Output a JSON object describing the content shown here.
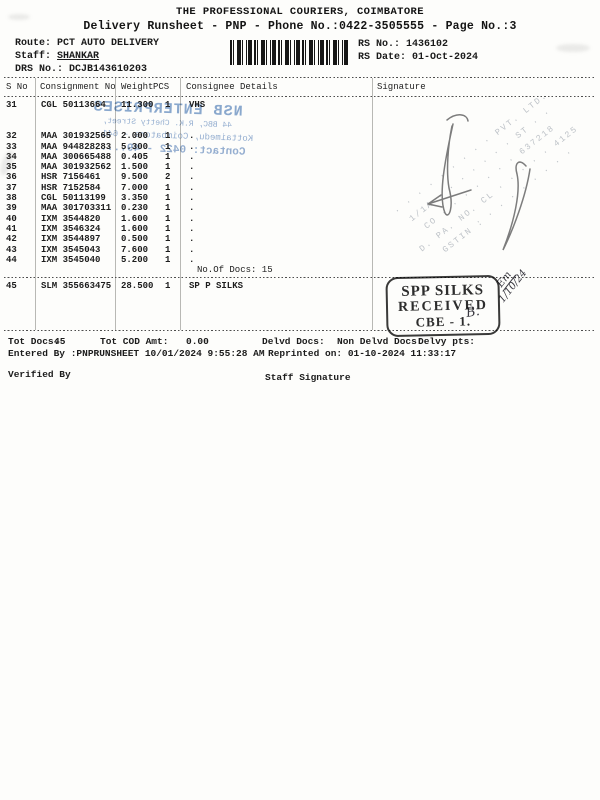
{
  "header": {
    "title": "THE PROFESSIONAL COURIERS, COIMBATORE",
    "subtitle": "Delivery Runsheet - PNP - Phone No.:0422-3505555 - Page No.:3",
    "route_label": "Route:",
    "route_value": "PCT AUTO DELIVERY",
    "staff_label": "Staff:",
    "staff_value": "SHANKAR",
    "drs_label": "DRS No.:",
    "drs_value": "DCJB143610203",
    "rs_no_label": "RS No.:",
    "rs_no_value": "1436102",
    "rs_date_label": "RS Date:",
    "rs_date_value": "01-Oct-2024"
  },
  "table": {
    "columns": [
      "S No",
      "Consignment No",
      "Weight",
      "PCS",
      "Consignee Details",
      "Signature"
    ],
    "rows": [
      {
        "s_no": "31",
        "consignment": "CGL 50113664",
        "weight": "11.300",
        "pcs": "1",
        "consignee": "VHS"
      },
      {
        "s_no": "32",
        "consignment": "MAA 301932565",
        "weight": "2.000",
        "pcs": "1",
        "consignee": "."
      },
      {
        "s_no": "33",
        "consignment": "MAA 944828283",
        "weight": "5.300",
        "pcs": "1",
        "consignee": "."
      },
      {
        "s_no": "34",
        "consignment": "MAA 300665488",
        "weight": "0.405",
        "pcs": "1",
        "consignee": "."
      },
      {
        "s_no": "35",
        "consignment": "MAA 301932562",
        "weight": "1.500",
        "pcs": "1",
        "consignee": "."
      },
      {
        "s_no": "36",
        "consignment": "HSR 7156461",
        "weight": "9.500",
        "pcs": "2",
        "consignee": "."
      },
      {
        "s_no": "37",
        "consignment": "HSR 7152584",
        "weight": "7.000",
        "pcs": "1",
        "consignee": "."
      },
      {
        "s_no": "38",
        "consignment": "CGL 50113199",
        "weight": "3.350",
        "pcs": "1",
        "consignee": "."
      },
      {
        "s_no": "39",
        "consignment": "MAA 301703311",
        "weight": "0.230",
        "pcs": "1",
        "consignee": "."
      },
      {
        "s_no": "40",
        "consignment": "IXM 3544820",
        "weight": "1.600",
        "pcs": "1",
        "consignee": "."
      },
      {
        "s_no": "41",
        "consignment": "IXM 3546324",
        "weight": "1.600",
        "pcs": "1",
        "consignee": "."
      },
      {
        "s_no": "42",
        "consignment": "IXM 3544897",
        "weight": "0.500",
        "pcs": "1",
        "consignee": "."
      },
      {
        "s_no": "43",
        "consignment": "IXM 3545043",
        "weight": "7.600",
        "pcs": "1",
        "consignee": "."
      },
      {
        "s_no": "44",
        "consignment": "IXM 3545040",
        "weight": "5.200",
        "pcs": "1",
        "consignee": "."
      }
    ],
    "docs_note": "No.Of Docs: 15",
    "last_row": {
      "s_no": "45",
      "consignment": "SLM 355663475",
      "weight": "28.500",
      "pcs": "1",
      "consignee": "SP P SILKS"
    }
  },
  "watermark": {
    "line1": "NSB ENTERPRISES",
    "line2": "44 BBC, R.K. Chetty Street,",
    "line3": "Kottaimedu, Coimbatore - 641 ...",
    "line4": "Contact: 0422 - 49......",
    "color": "#7b9cc9"
  },
  "faint_stamp": {
    "lines": [
      "· · · · · · · · ·  PVT. LTD.",
      "1/1A · · · · · · · ST · ·",
      "CO · · · · · · · 637218",
      "D. PA. NO. CL · · · · · 4125",
      "GSTIN : · · · · · · · ·"
    ]
  },
  "received_stamp": {
    "line1": "SPP SILKS",
    "line2": "RECEIVED",
    "line3": "CBE - 1.",
    "handwriting_initial": "B.",
    "handwriting_note": "Em",
    "handwriting_date": "1/10/24",
    "ink_color": "#2d2d2d"
  },
  "footer": {
    "totals": [
      {
        "label": "Tot Docs:",
        "value": "45"
      },
      {
        "label": "Tot COD Amt:",
        "value": "0.00"
      },
      {
        "label": "Delvd Docs:",
        "value": ""
      },
      {
        "label": "Non Delvd Docs:",
        "value": ""
      },
      {
        "label": "Delvy pts:",
        "value": ""
      }
    ],
    "entered_by": "Entered By :PNPRUNSHEET 10/01/2024 9:55:28 AM",
    "reprinted": "Reprinted on: 01-10-2024 11:33:17",
    "verified_by": "Verified By",
    "staff_signature": "Staff Signature"
  }
}
